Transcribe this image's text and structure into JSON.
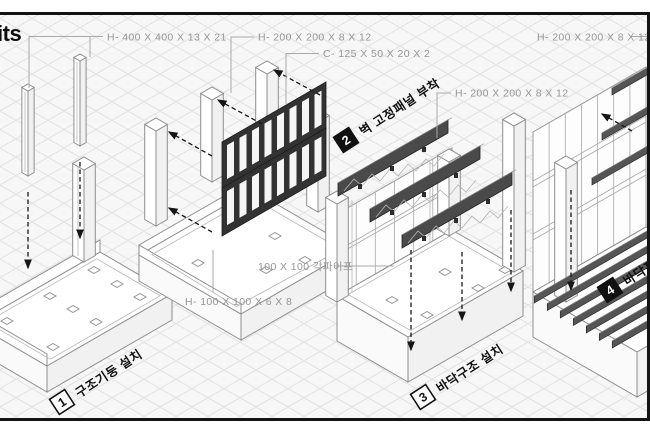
{
  "title_fragment": "its",
  "colors": {
    "frame_border": "#141414",
    "grid_line": "#e3e3e3",
    "grid_bg": "#f7f7f7",
    "spec_text": "#969696",
    "dark_part": "#323232",
    "step_text": "#111111"
  },
  "spec_labels": [
    {
      "id": "col-h400",
      "text": "H- 400 X 400 X 13 X 21"
    },
    {
      "id": "col-h200",
      "text": "H- 200 X 200 X 8 X 12"
    },
    {
      "id": "chan-c125",
      "text": "C- 125 X 50 X 20 X 2"
    },
    {
      "id": "beam-h200",
      "text": "H- 200 X 200 X 8 X 12"
    },
    {
      "id": "beam-h200-right",
      "text": "H- 200 X 200 X 8 X 12"
    },
    {
      "id": "pipe-100",
      "text": "100 X 100 각파이프"
    },
    {
      "id": "base-h100",
      "text": "H- 100 X 100 X 6 X 8"
    }
  ],
  "steps": [
    {
      "num": "1",
      "label": "구조기둥 설치",
      "badge_style": "light"
    },
    {
      "num": "2",
      "label": "벽 고정패널 부착",
      "badge_style": "dark"
    },
    {
      "num": "3",
      "label": "바닥구조 설치",
      "badge_style": "light"
    },
    {
      "num": "4",
      "label": "바닥프레임 설치",
      "badge_style": "dark"
    }
  ]
}
